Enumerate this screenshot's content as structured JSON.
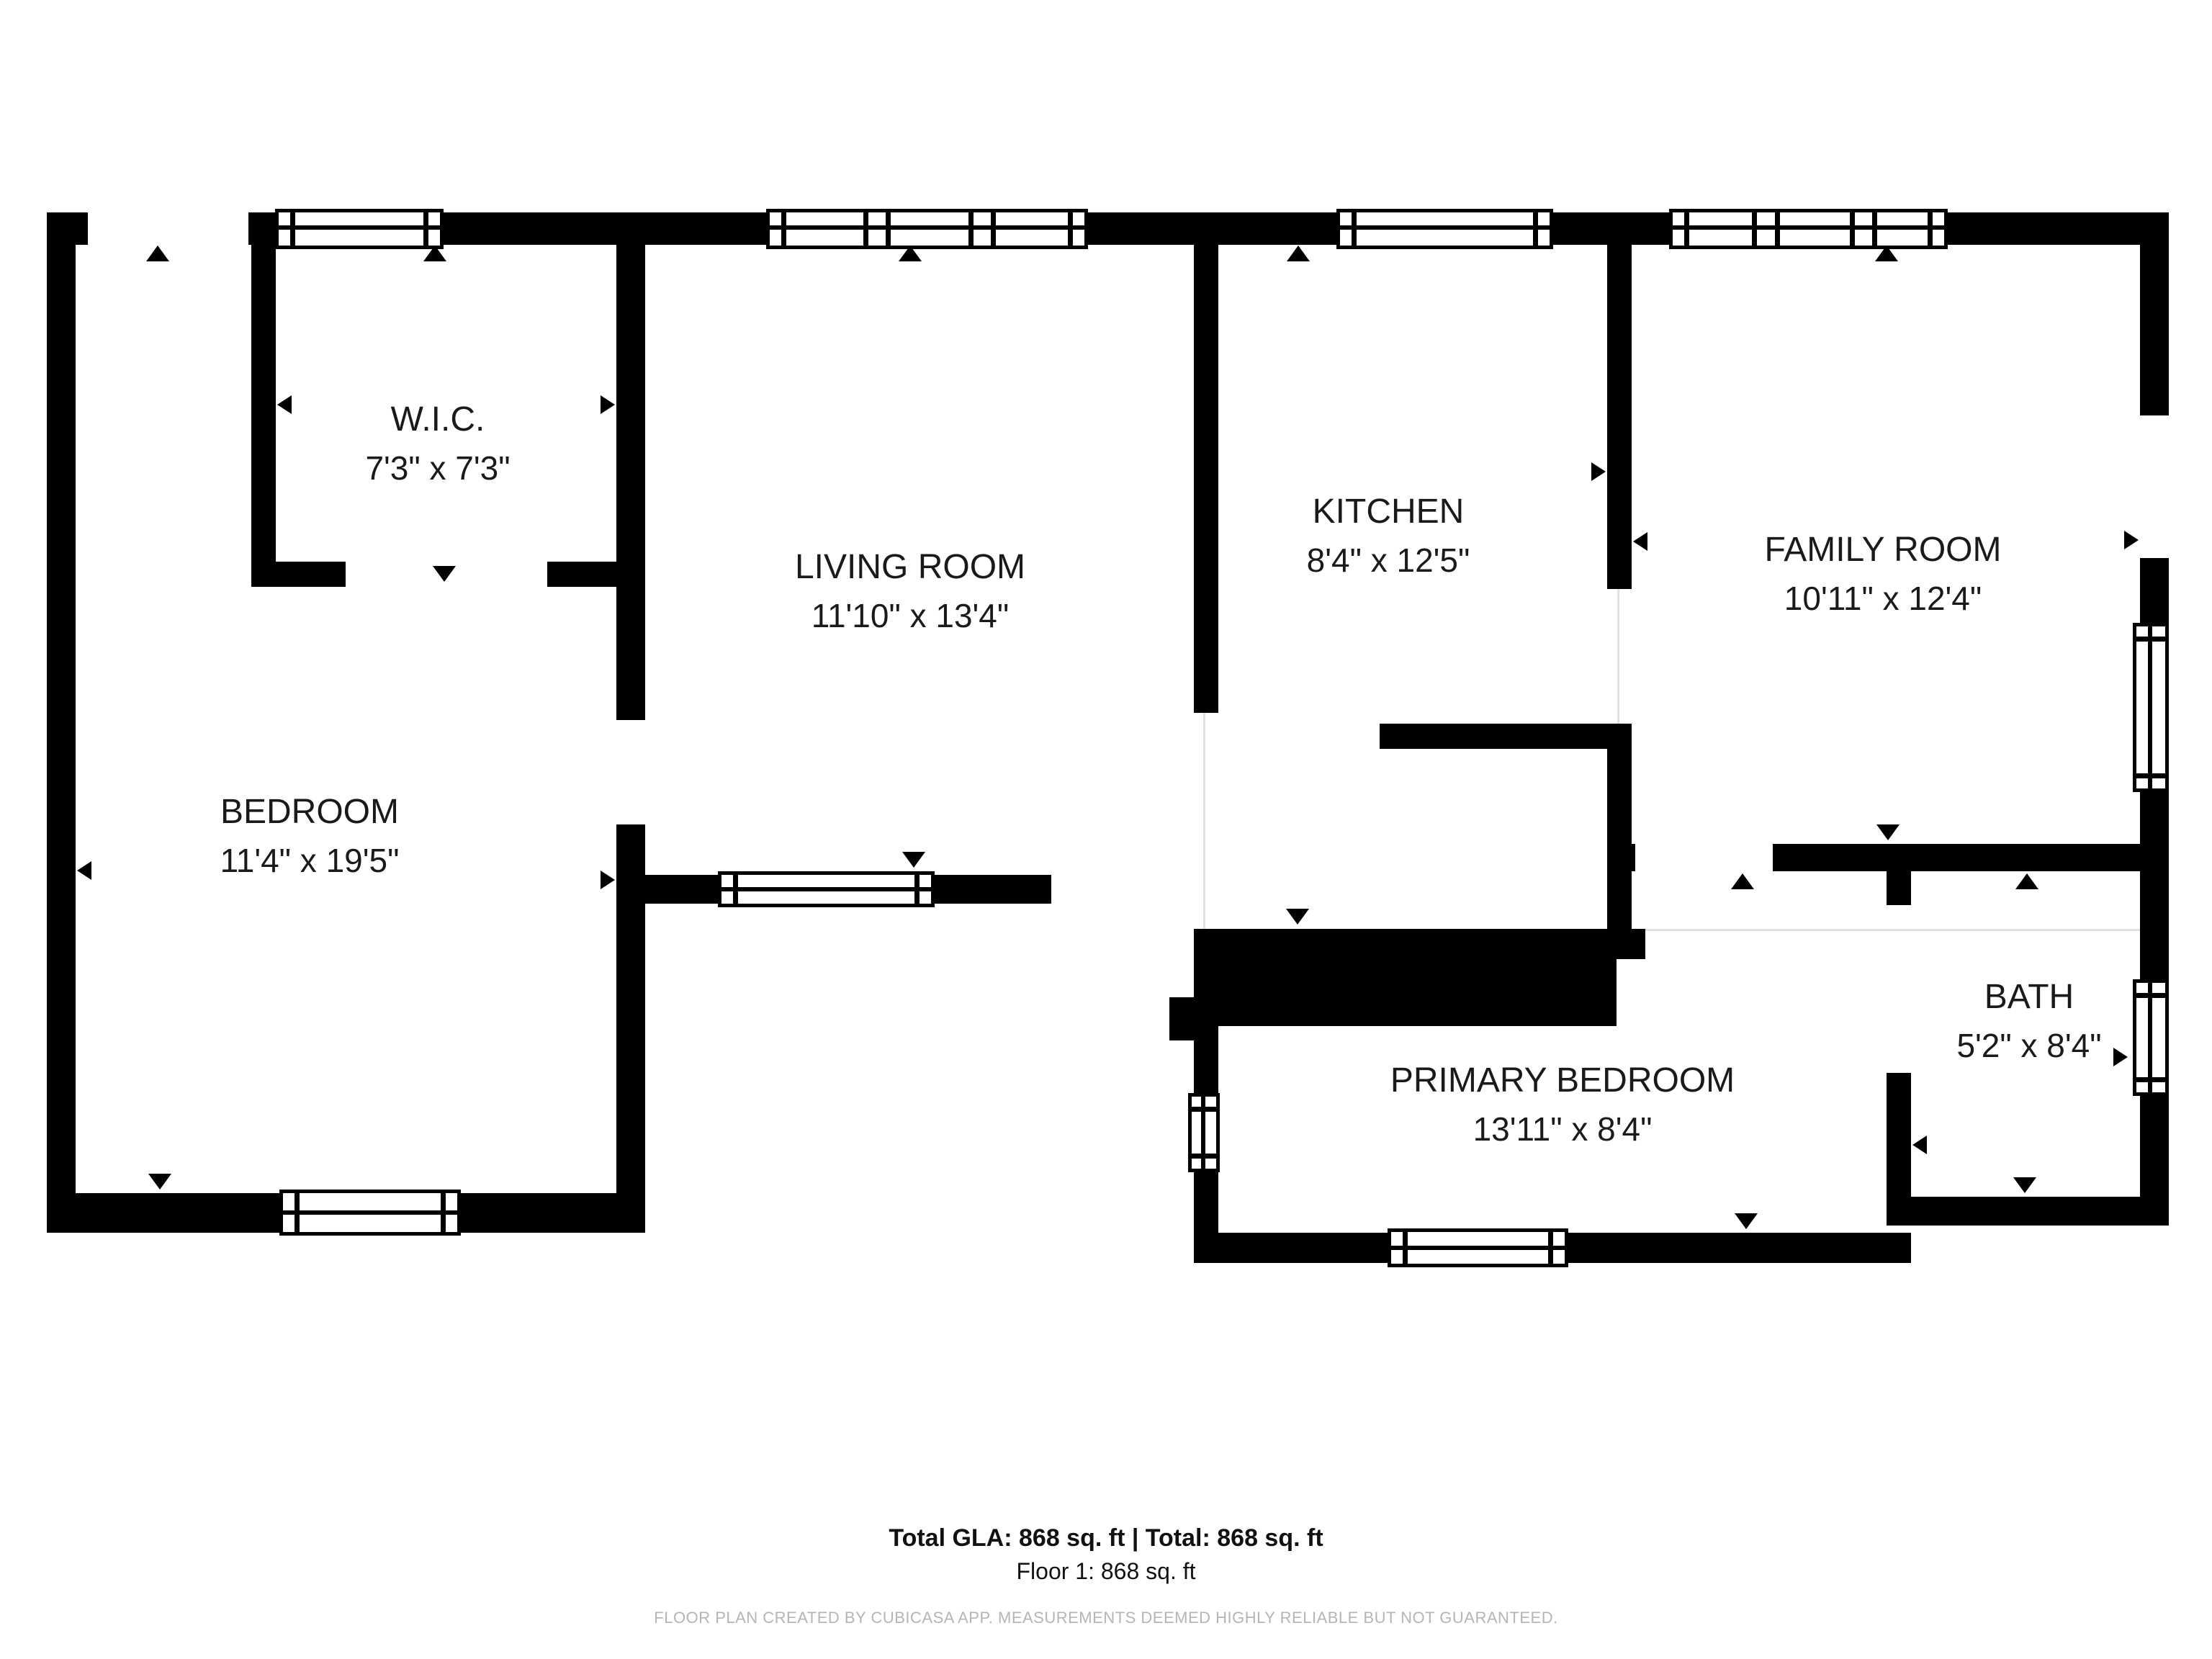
{
  "title": "Floor plan - Floor 1",
  "rooms": [
    {
      "name": "W.I.C.",
      "dims": "7'3\" x 7'3\""
    },
    {
      "name": "LIVING ROOM",
      "dims": "11'10\" x 13'4\""
    },
    {
      "name": "KITCHEN",
      "dims": "8'4\" x 12'5\""
    },
    {
      "name": "FAMILY ROOM",
      "dims": "10'11\" x 12'4\""
    },
    {
      "name": "BEDROOM",
      "dims": "11'4\" x 19'5\""
    },
    {
      "name": "PRIMARY BEDROOM",
      "dims": "13'11\" x 8'4\""
    },
    {
      "name": "BATH",
      "dims": "5'2\" x 8'4\""
    }
  ],
  "footer": {
    "totals": "Total GLA: 868 sq. ft | Total: 868 sq. ft",
    "floor": "Floor 1: 868 sq. ft",
    "disclaimer": "FLOOR PLAN CREATED BY CUBICASA APP. MEASUREMENTS DEEMED HIGHLY RELIABLE BUT NOT GUARANTEED."
  },
  "icons": {
    "door_direction": "door-direction-icon (small black triangle marking door/opening swing)",
    "window": "double-line window symbol"
  },
  "colors": {
    "wall": "#000000",
    "text": "#1a1a1a",
    "disclaimer_text": "#b5b5b5",
    "background": "#ffffff"
  }
}
